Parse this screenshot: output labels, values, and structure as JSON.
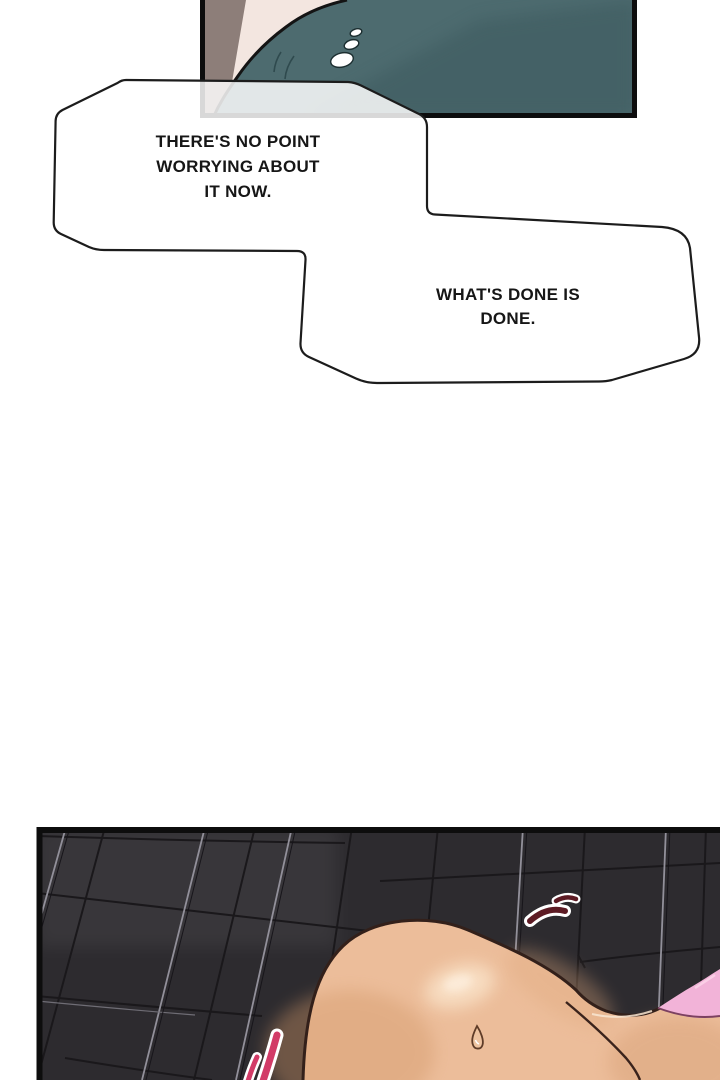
{
  "page": {
    "width": 720,
    "height": 1080,
    "background": "#ffffff",
    "kind": "comic page"
  },
  "speech_bubbles": {
    "bubble_1": {
      "lines": [
        "THERE'S NO POINT",
        "WORRYING ABOUT",
        "IT NOW."
      ]
    },
    "bubble_2": {
      "lines": [
        "WHAT'S DONE IS",
        "DONE."
      ]
    }
  },
  "panels": {
    "top_panel": {
      "description": "Cropped close-up: teal shirt over a shoulder, pale skin, brown-grey hair edge, three white sheen ovals on the fabric."
    },
    "bottom_panel": {
      "description": "Low-angle view against a dark slanted tile wall: a bent-over figure, pink cloth at the right edge, red startle marks, one sweat drop."
    }
  },
  "colors": {
    "ink": "#1c1c1c",
    "panel_border": "#0d0d0d",
    "bubble_fill": "rgba(255,255,255,0.84)",
    "text": "#161616",
    "teal": "#4d6b6f",
    "teal_dark": "#3c5a5f",
    "cream": "#f3e6e0",
    "brown": "#8d7e79",
    "tile": "#2d2b2f",
    "grout_light": "#92909a",
    "seam_dark": "#1a181b",
    "skin": "#ecbd9a",
    "skin_highlight": "#fae4ca",
    "skin_shadow": "#d29768",
    "skin_outline": "#33201a",
    "pink_cloth": "#f2b3d8",
    "pink_edge": "#7c4161",
    "mark_maroon": "#5d1b24",
    "mark_crimson": "#d23b67",
    "mark_casing": "#ffffff"
  }
}
